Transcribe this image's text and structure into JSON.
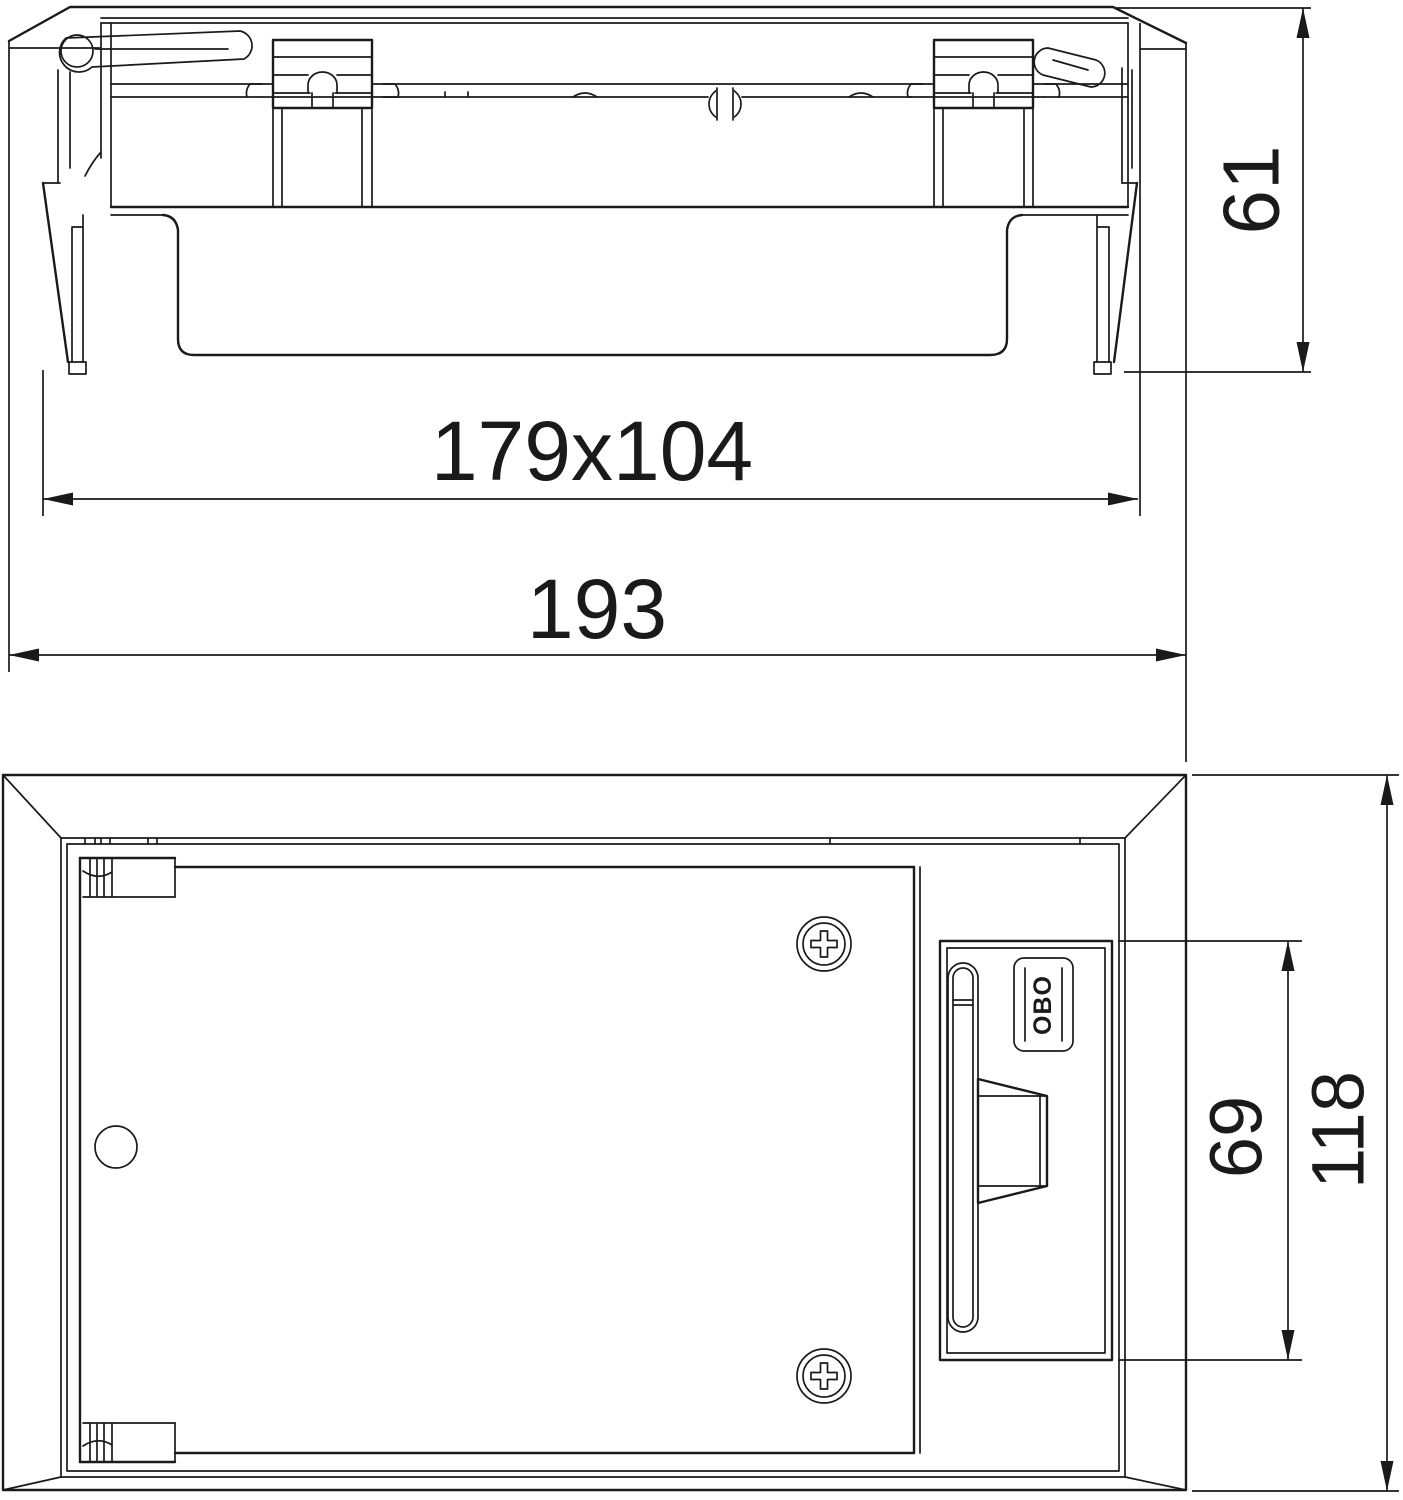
{
  "colors": {
    "line": "#1a1a1a",
    "background": "#ffffff"
  },
  "dims": {
    "cutout": {
      "label": "179x104"
    },
    "width": {
      "label": "193"
    },
    "height": {
      "label": "61"
    },
    "latch": {
      "label": "69"
    },
    "depth": {
      "label": "118"
    }
  },
  "logo": {
    "text": "OBO"
  }
}
